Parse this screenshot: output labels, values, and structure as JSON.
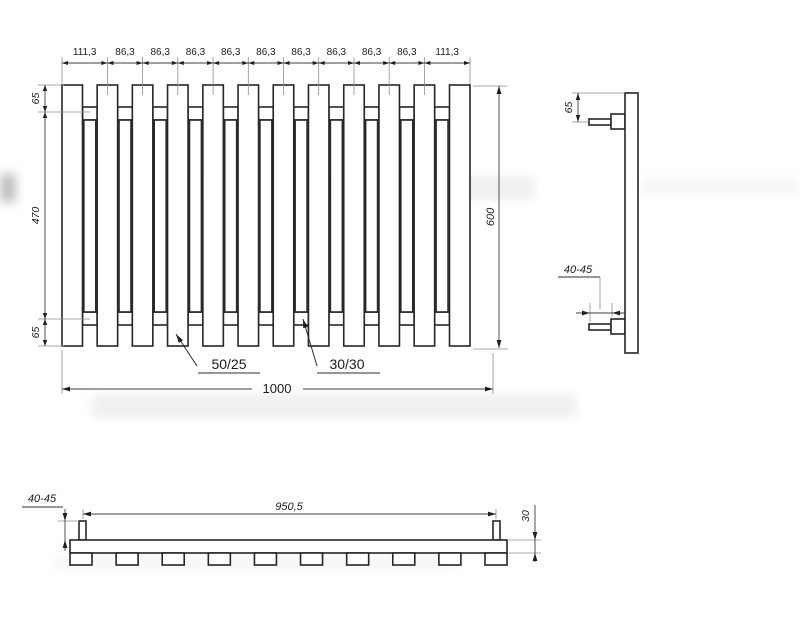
{
  "drawing": {
    "kind": "radiator-technical-drawing",
    "colors": {
      "line": "#262626",
      "dim": "#3f3f3f",
      "extension": "#8f8f8f",
      "background": "#ffffff"
    },
    "front_view": {
      "top_dimensions": [
        "111,3",
        "86,3",
        "86,3",
        "86,3",
        "86,3",
        "86,3",
        "86,3",
        "86,3",
        "86,3",
        "86,3",
        "111,3"
      ],
      "left_dimensions": [
        "65",
        "470",
        "65"
      ],
      "right_dimension": "600",
      "bottom_dimension": "1000",
      "wide_profile_label": "50/25",
      "narrow_profile_label": "30/30",
      "wide_bar_count": 12,
      "narrow_bar_count": 11
    },
    "side_view": {
      "top_offset": "65",
      "connection_length": "40-45"
    },
    "bottom_view": {
      "connection_spacing": "950,5",
      "connection_length": "40-45",
      "depth": "30",
      "square_count": 10
    }
  }
}
